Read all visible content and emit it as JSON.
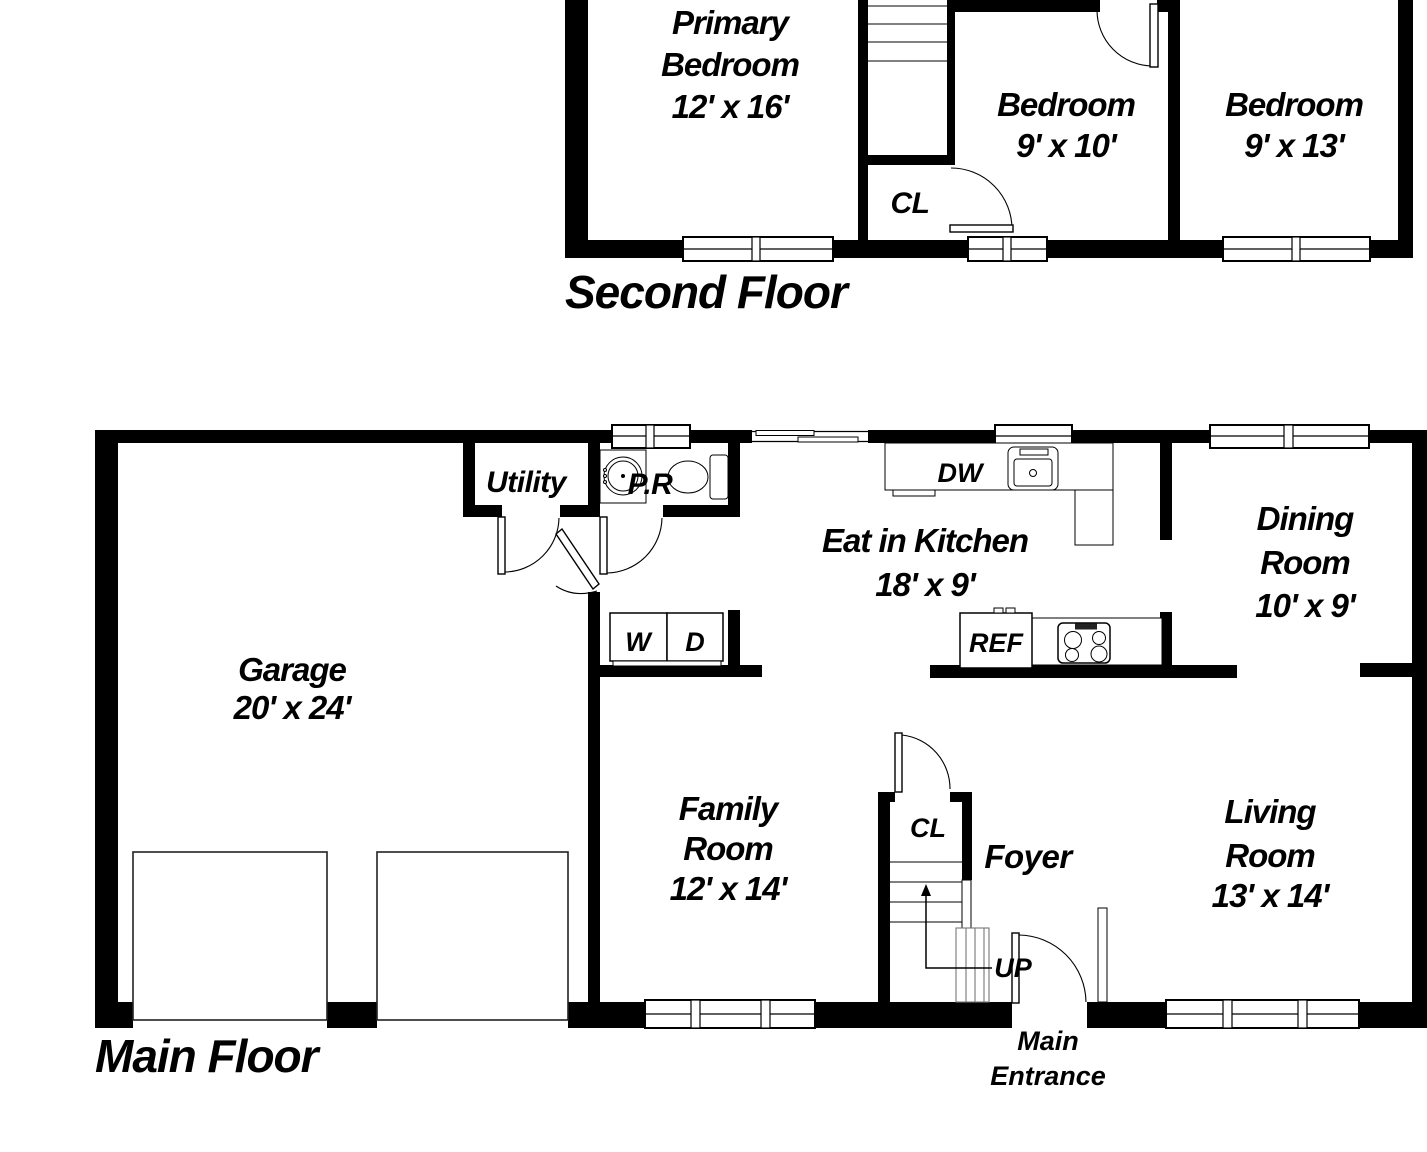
{
  "second_floor": {
    "title": "Second Floor",
    "primary_bedroom": {
      "line1": "Primary",
      "line2": "Bedroom",
      "dims": "12' x 16'"
    },
    "bedroom_9x10": {
      "name": "Bedroom",
      "dims": "9' x 10'"
    },
    "bedroom_9x13": {
      "name": "Bedroom",
      "dims": "9' x 13'"
    },
    "closet": {
      "label": "CL"
    }
  },
  "main_floor": {
    "title": "Main Floor",
    "garage": {
      "name": "Garage",
      "dims": "20' x 24'"
    },
    "utility": {
      "label": "Utility"
    },
    "powder_room": {
      "label": "P.R"
    },
    "kitchen": {
      "name": "Eat in Kitchen",
      "dims": "18' x 9'"
    },
    "dining_room": {
      "line1": "Dining",
      "line2": "Room",
      "dims": "10' x 9'"
    },
    "family_room": {
      "line1": "Family",
      "line2": "Room",
      "dims": "12' x 14'"
    },
    "living_room": {
      "line1": "Living",
      "line2": "Room",
      "dims": "13' x 14'"
    },
    "foyer": {
      "label": "Foyer"
    },
    "closet": {
      "label": "CL"
    },
    "stairs": {
      "label": "UP"
    },
    "appliances": {
      "dishwasher": "DW",
      "refrigerator": "REF",
      "washer": "W",
      "dryer": "D"
    },
    "entrance": {
      "line1": "Main",
      "line2": "Entrance"
    }
  }
}
